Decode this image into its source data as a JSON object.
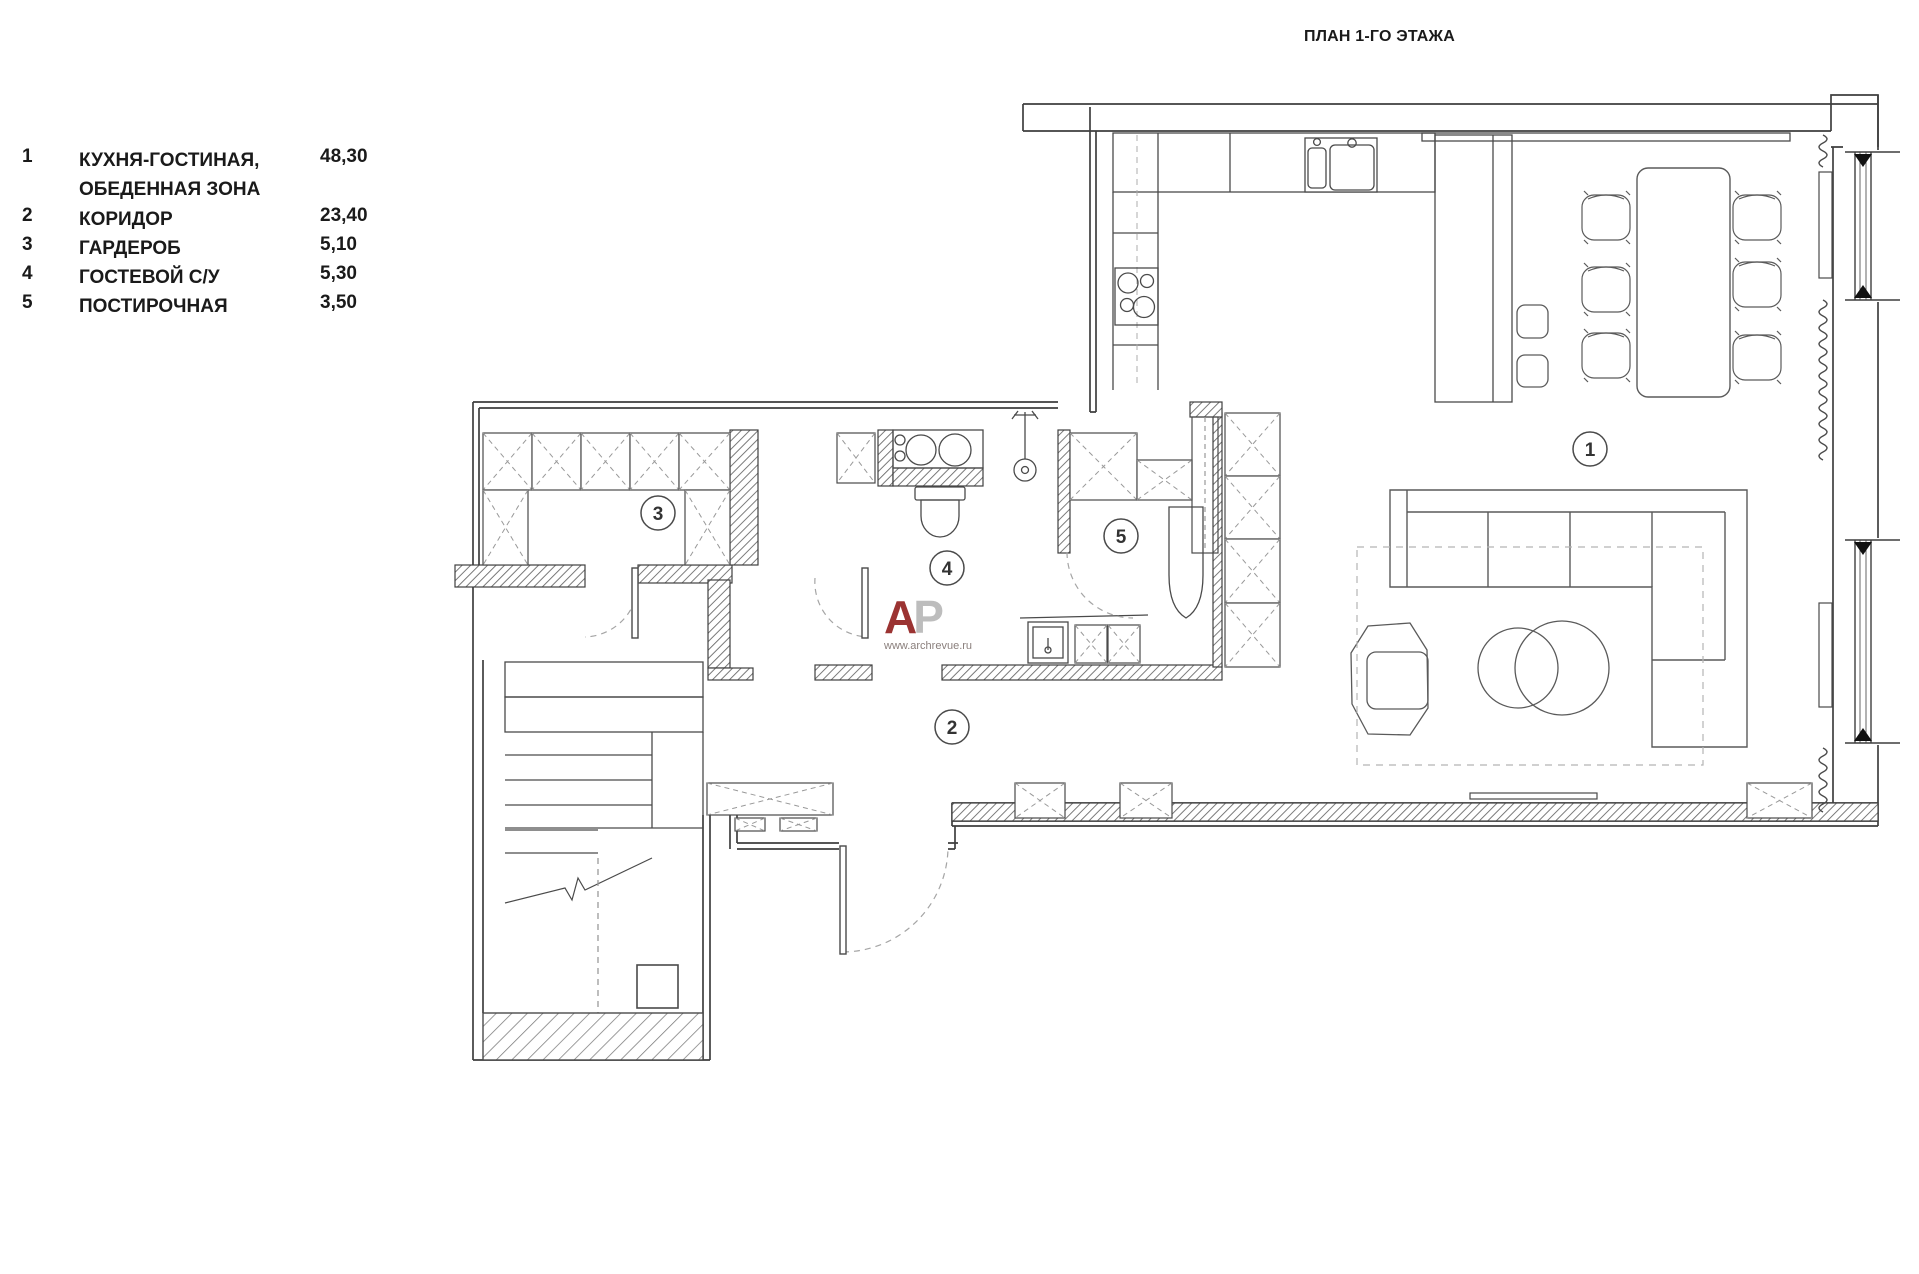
{
  "title": "ПЛАН 1-ГО ЭТАЖА",
  "legend": {
    "rows": [
      {
        "num": "1",
        "name": "КУХНЯ-ГОСТИНАЯ,",
        "name2": "ОБЕДЕННАЯ ЗОНА",
        "area": "48,30"
      },
      {
        "num": "2",
        "name": "КОРИДОР",
        "name2": "",
        "area": "23,40"
      },
      {
        "num": "3",
        "name": "ГАРДЕРОБ",
        "name2": "",
        "area": "5,10"
      },
      {
        "num": "4",
        "name": "ГОСТЕВОЙ С/У",
        "name2": "",
        "area": "5,30"
      },
      {
        "num": "5",
        "name": "ПОСТИРОЧНАЯ",
        "name2": "",
        "area": "3,50"
      }
    ]
  },
  "room_markers": [
    {
      "n": "1"
    },
    {
      "n": "2"
    },
    {
      "n": "3"
    },
    {
      "n": "4"
    },
    {
      "n": "5"
    }
  ],
  "watermark": {
    "letter_a": "A",
    "letter_p": "P",
    "url": "www.archrevue.ru"
  },
  "colors": {
    "line": "#3f3f3f",
    "furniture": "#5a5a5a",
    "hatch": "#6b6b6b",
    "dashed": "#9a9a9a",
    "accent_red": "#9b3332",
    "watermark_gray": "#bdbdbd"
  }
}
